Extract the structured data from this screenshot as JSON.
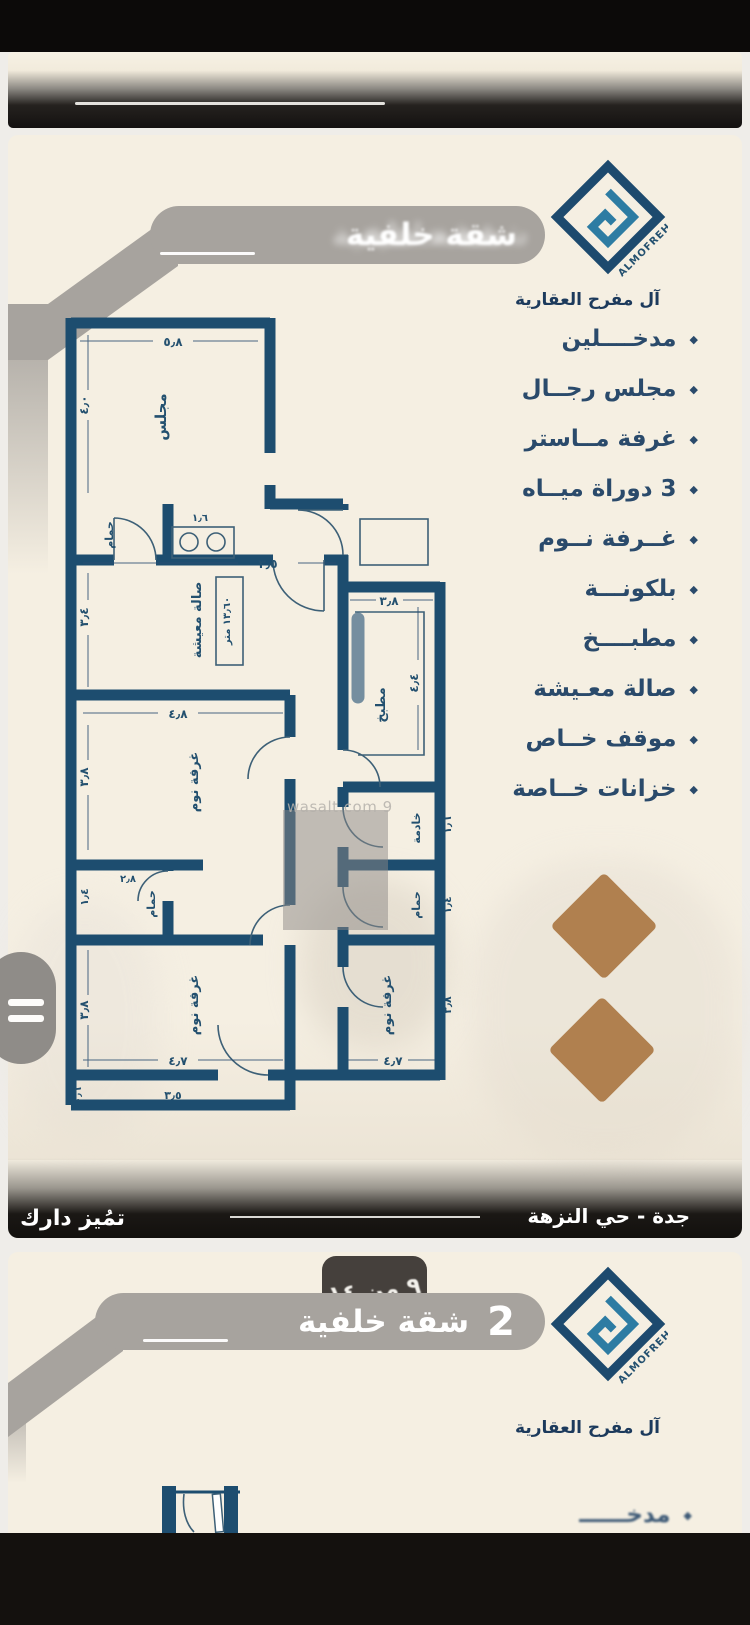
{
  "page": {
    "company_name": "آل مفرح العقارية",
    "logo_text": "ALMOFREH"
  },
  "panel1": {
    "banner_title": "شقة خلفية",
    "features": [
      "مدخــــلين",
      "مجلس رجــال",
      "غرفة مــاستر",
      "3 دوراة ميــاه",
      "غــرفة نــوم",
      "بلكونـــة",
      "مطبــــخ",
      "صالة معـيشة",
      "موقف خــاص",
      "خزانات خــاصة"
    ],
    "watermark": "wasalt.com 9",
    "footer": {
      "location": "جدة - حي النزهة",
      "tagline": "تمُيز دارك"
    }
  },
  "plan": {
    "rooms": {
      "majlis": "مجلس",
      "bath": "حمام",
      "living": "صالة معيشة",
      "living_area": "١٣٫٦٠ متر",
      "kitchen": "مطبخ",
      "bedroom": "غرفة نوم",
      "maid": "خادمة"
    },
    "dims": {
      "majlis_w": "٥٫٨",
      "majlis_h": "٤٫٠",
      "living_w": "٣٫٥",
      "living_h": "٣٫٤",
      "kitchen_w": "٣٫٨",
      "kitchen_h": "٤٫٤",
      "bed_w": "٤٫٨",
      "bed_side": "٣٫٨",
      "bed_bottom": "٤٫٧",
      "bath_w": "٢٫٨",
      "bath_h": "١٫٤",
      "vanity_w": "١٫٦",
      "maid_side": "١٫٦",
      "side_right": "١٫٦",
      "balcony_w": "٣٫٥",
      "balcony_h": "٠٫٦"
    }
  },
  "panel2": {
    "page_badge": "٩ من ١٤",
    "banner_title": "شقة خلفية",
    "banner_number": "2",
    "partial_item": "مدخــــــ"
  }
}
